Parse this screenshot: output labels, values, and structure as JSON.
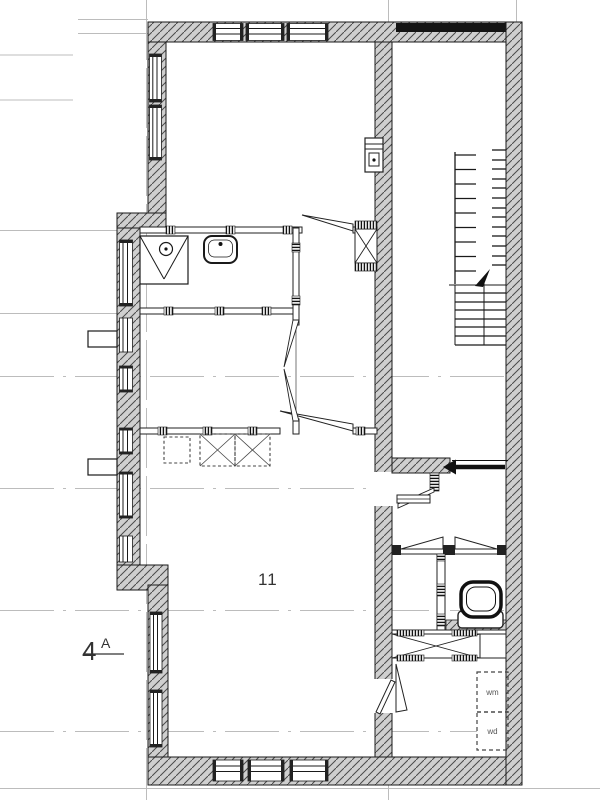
{
  "labels": {
    "room_number": "11",
    "section_mark_number": "4",
    "section_mark_letter": "A",
    "washing_machine": "wm",
    "dryer": "wd"
  },
  "icons": {
    "toilet": "toilet-icon",
    "sink": "sink-icon",
    "shower": "shower-tray-icon",
    "stairs": "staircase-icon",
    "stair_arrow": "stair-direction-arrow-icon",
    "sliding_door": "sliding-door-arrow-icon",
    "utility_box": "utility-meter-box-icon",
    "kitchen_units": "kitchen-unit-dashed-icon",
    "duct": "duct-shaft-icon"
  },
  "colors": {
    "background": "#ffffff",
    "wall_fill": "#cfcfcf",
    "wall_hatch": "#4a4a4a",
    "line": "#1a1a1a",
    "grid_line": "#bcbcbc",
    "lintel_band": "#141414",
    "label_text": "#333333"
  }
}
